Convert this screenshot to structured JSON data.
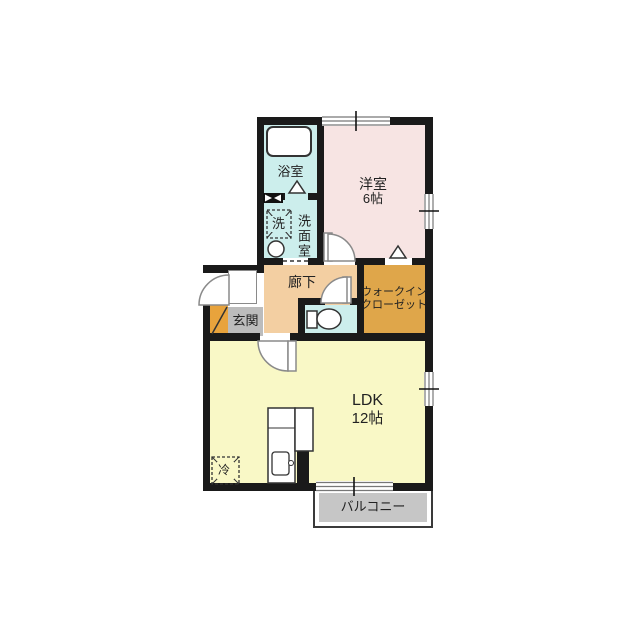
{
  "colors": {
    "wall": "#1a1a1a",
    "wet_area": "#cceeec",
    "western_room": "#f7e4e3",
    "hallway": "#f3cfa2",
    "closet": "#dfa64a",
    "ldk": "#f9f8c6",
    "genkan_tile": "#bcbcbc",
    "genkan_step": "#e8a33c",
    "balcony": "#c6c6c6"
  },
  "rooms": {
    "bathroom": {
      "label": "浴室"
    },
    "washroom": {
      "label": "洗面室"
    },
    "washer": {
      "label": "洗"
    },
    "western": {
      "label": "洋室",
      "size": "6帖"
    },
    "hallway": {
      "label": "廊下"
    },
    "genkan": {
      "label": "玄関"
    },
    "closet": {
      "line1": "ウォークイン",
      "line2": "クローゼット"
    },
    "ldk": {
      "label": "LDK",
      "size": "12帖"
    },
    "fridge": {
      "label": "冷"
    },
    "balcony": {
      "label": "バルコニー"
    }
  }
}
